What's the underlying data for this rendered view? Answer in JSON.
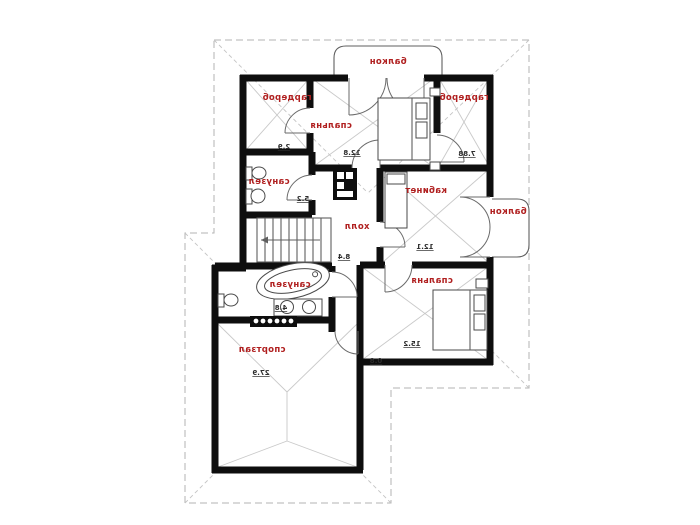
{
  "plan": {
    "kind": "attic-floor-plan",
    "language": "ru",
    "text_mirrored": true,
    "colors": {
      "label_accent": "#b01f1f",
      "wall": "#0e0e0e",
      "area_number": "#2c2c2c",
      "roof_dash": "#b3b3b3"
    },
    "rooms": {
      "balcony_top": {
        "label": "балкон",
        "area": ""
      },
      "wardrobe_left": {
        "label": "гардероб",
        "area": "2.9"
      },
      "bedroom_top": {
        "label": "спальня",
        "area": "12.8"
      },
      "wardrobe_right": {
        "label": "гардероб",
        "area": "7.88"
      },
      "bathroom_top": {
        "label": "санузел",
        "area": "5.2"
      },
      "study": {
        "label": "кабинет",
        "area": "12.1"
      },
      "hall": {
        "label": "холл",
        "area": "8.4"
      },
      "balcony_right": {
        "label": "балкон",
        "area": ""
      },
      "bathroom_low": {
        "label": "санузел",
        "area": "4.8"
      },
      "bedroom_low": {
        "label": "спальня",
        "area": "15.2"
      },
      "gym": {
        "label": "спортзал",
        "area": "27.9"
      }
    },
    "misc": {
      "small_dim": "0.8"
    }
  }
}
